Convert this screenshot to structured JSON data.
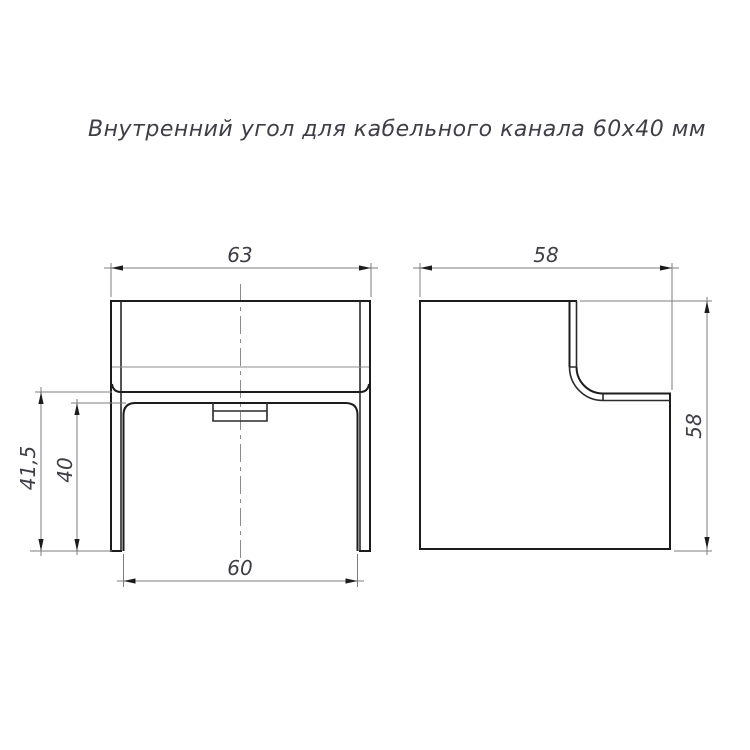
{
  "title": {
    "text": "Внутренний угол для кабельного канала 60х40 мм"
  },
  "drawing": {
    "kind": "two-view orthographic technical drawing of cable-channel internal corner",
    "views": {
      "front": {
        "label": "front-view",
        "dimensions": {
          "top_width": {
            "value": "63"
          },
          "bottom_width": {
            "value": "60"
          },
          "left_outer_height": {
            "value": "41,5"
          },
          "left_inner_height": {
            "value": "40"
          }
        }
      },
      "side": {
        "label": "side-view",
        "dimensions": {
          "top_width": {
            "value": "58"
          },
          "right_height": {
            "value": "58"
          }
        }
      }
    },
    "colors": {
      "outline": "#1c1c1c",
      "thin_line": "#8c8c8c",
      "dimension_line": "#7d7d7d",
      "text": "#3e3e46",
      "background": "#ffffff"
    }
  }
}
